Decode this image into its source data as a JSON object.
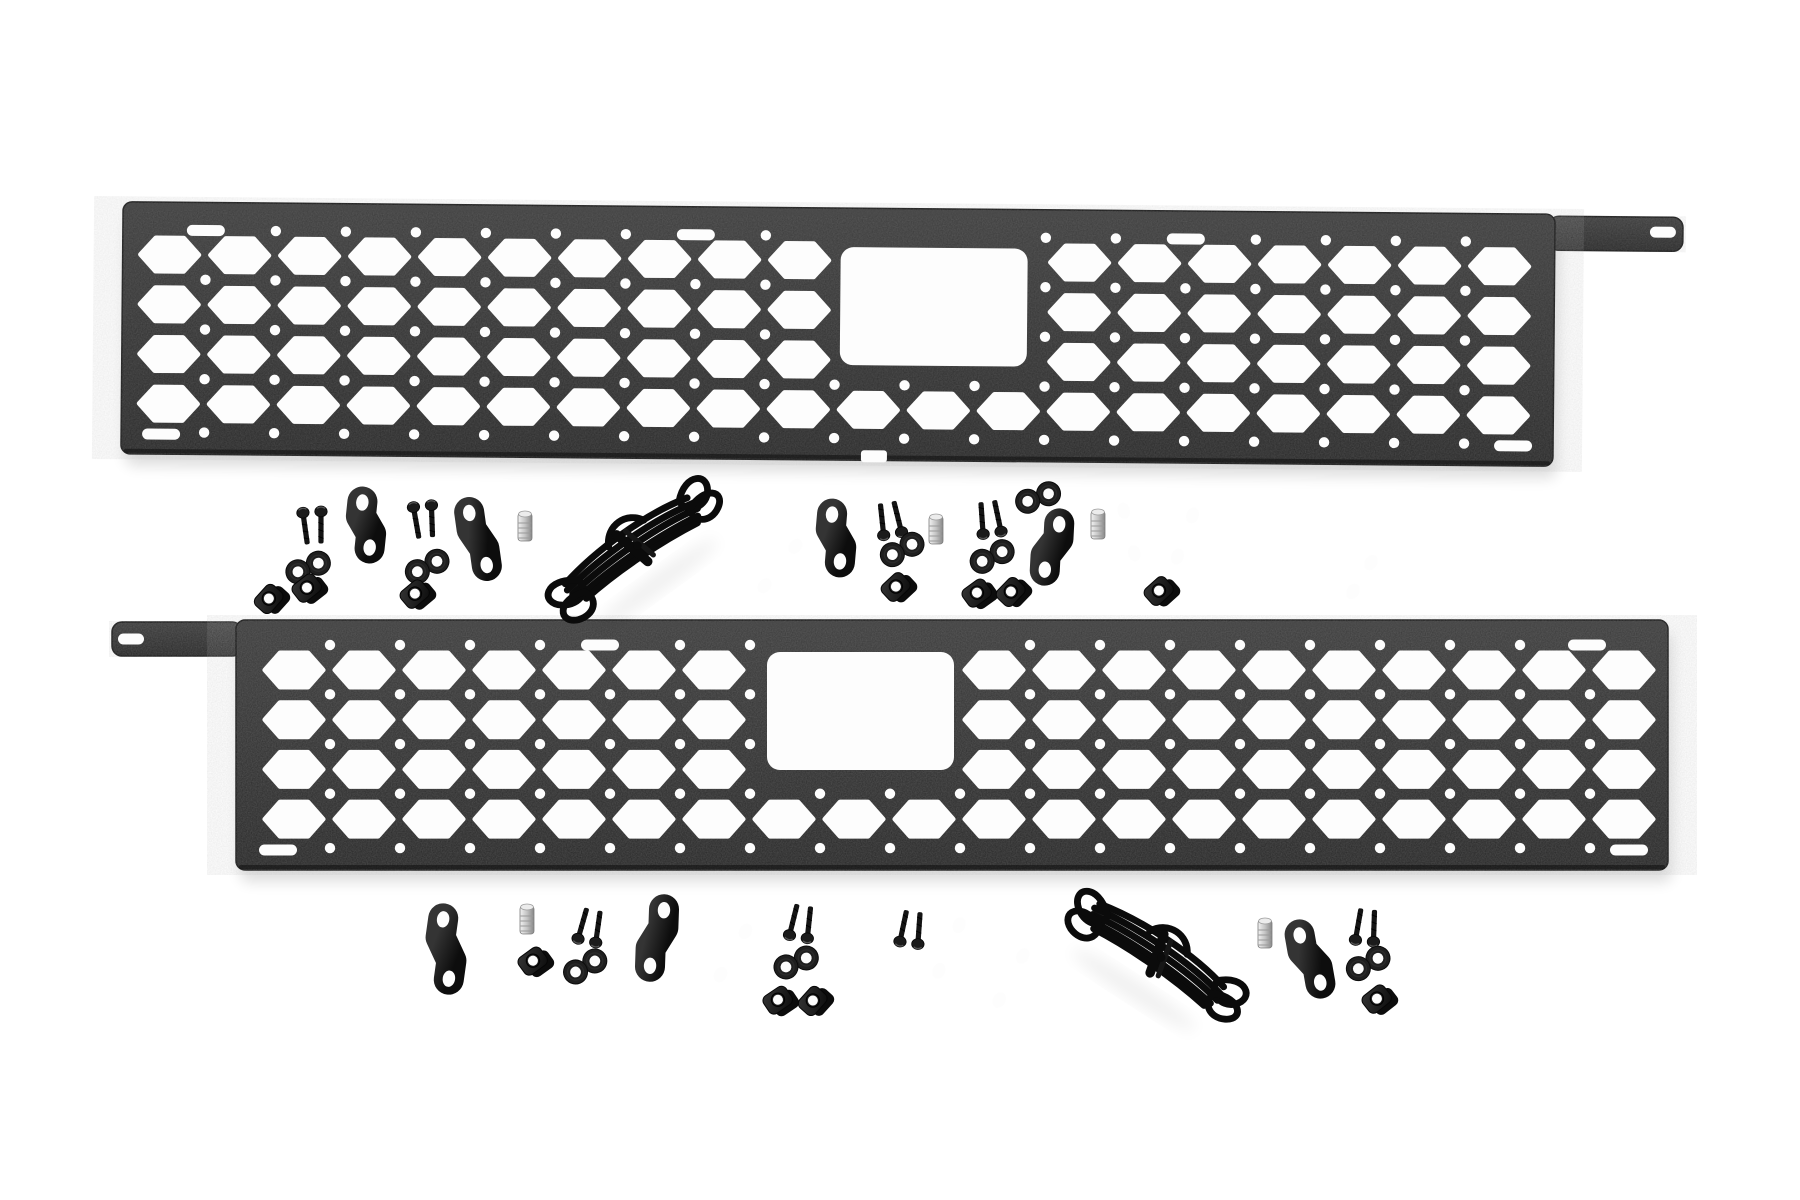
{
  "scene": {
    "width": 1800,
    "height": 1200,
    "background": "#ffffff",
    "subject": "molle-panel-kit-product-photo"
  },
  "colors": {
    "panelTop": "#3a3a3a",
    "panelBottom": "#252525",
    "panelEdge": "#161616",
    "panelHighlight": "#4a4a4a",
    "hole": "#fdfdfd",
    "strapLight": "#343434",
    "strapDark": "#0d0d0d",
    "hardware": "#141414",
    "washer": "#1f1f1f",
    "cord": "#0b0b0b",
    "studLight": "#f2f2f2",
    "studMid": "#c4c4c4",
    "studDark": "#878787",
    "shadow": "#000000"
  },
  "panels": [
    {
      "name": "molle-panel-top",
      "x": 122,
      "y": 208,
      "width": 1432,
      "height": 252,
      "rotation": 0.5,
      "tab": {
        "side": "right",
        "width": 134,
        "height": 34,
        "slot": {
          "x": 1662,
          "y": 225,
          "w": 26,
          "h": 11
        }
      },
      "window": {
        "x": 840,
        "y": 247,
        "w": 187,
        "h": 118,
        "r": 13
      },
      "grid": {
        "cols": 20,
        "colPitch": 70,
        "startX": 18,
        "hexW": 58,
        "hexH": 33,
        "rows": 4,
        "rowPitch": 49.7,
        "startY": 36
      },
      "slots": [
        {
          "x": 205,
          "y": 236
        },
        {
          "x": 695,
          "y": 236
        },
        {
          "x": 1185,
          "y": 236
        },
        {
          "x": 162,
          "y": 440
        },
        {
          "x": 1514,
          "y": 440
        }
      ],
      "notches": [
        {
          "x": 875,
          "y": 456
        }
      ]
    },
    {
      "name": "molle-panel-bottom",
      "x": 236,
      "y": 620,
      "width": 1432,
      "height": 250,
      "rotation": 0,
      "tab": {
        "side": "left",
        "width": 130,
        "height": 34,
        "slot": {
          "x": 131,
          "y": 639,
          "w": 26,
          "h": 11
        }
      },
      "window": {
        "x": 767,
        "y": 652,
        "w": 187,
        "h": 118,
        "r": 13
      },
      "grid": {
        "cols": 20,
        "colPitch": 70,
        "startX": 29,
        "hexW": 58,
        "hexH": 34,
        "rows": 4,
        "rowPitch": 49.7,
        "startY": 33
      },
      "slots": [
        {
          "x": 600,
          "y": 645
        },
        {
          "x": 1587,
          "y": 645
        },
        {
          "x": 278,
          "y": 850
        },
        {
          "x": 1629,
          "y": 850
        }
      ],
      "notches": []
    }
  ],
  "hardware": [
    {
      "type": "screw-pair",
      "x": 313,
      "y": 527,
      "rot": -4,
      "flip": false
    },
    {
      "type": "washer-pair",
      "x": 308,
      "y": 567,
      "rot": 75
    },
    {
      "type": "clip-nut",
      "x": 268,
      "y": 599,
      "rot": -30
    },
    {
      "type": "clip-nut",
      "x": 306,
      "y": 588,
      "rot": -20
    },
    {
      "type": "z-bracket",
      "x": 366,
      "y": 525,
      "rot": 6,
      "len": 46,
      "dx": 12
    },
    {
      "type": "screw-pair",
      "x": 424,
      "y": 521,
      "rot": -6,
      "flip": false
    },
    {
      "type": "washer-pair",
      "x": 427,
      "y": 566,
      "rot": 70
    },
    {
      "type": "clip-nut",
      "x": 414,
      "y": 594,
      "rot": -22
    },
    {
      "type": "z-bracket",
      "x": 478,
      "y": 539,
      "rot": -8,
      "len": 56,
      "dx": 10
    },
    {
      "type": "stud",
      "x": 525,
      "y": 527,
      "rot": 0
    },
    {
      "type": "bracket",
      "x": 780,
      "y": 566,
      "rot": 38,
      "len": 52
    },
    {
      "type": "z-bracket",
      "x": 836,
      "y": 538,
      "rot": 5,
      "len": 48,
      "dx": 12
    },
    {
      "type": "screw-pair",
      "x": 890,
      "y": 519,
      "rot": -10,
      "flip": true
    },
    {
      "type": "washer-pair",
      "x": 902,
      "y": 549,
      "rot": 70
    },
    {
      "type": "clip-nut",
      "x": 895,
      "y": 587,
      "rot": -25
    },
    {
      "type": "stud",
      "x": 936,
      "y": 530,
      "rot": 0
    },
    {
      "type": "screw-pair",
      "x": 990,
      "y": 518,
      "rot": -8,
      "flip": true
    },
    {
      "type": "washer-pair",
      "x": 992,
      "y": 556,
      "rot": 72
    },
    {
      "type": "clip-nut",
      "x": 976,
      "y": 593,
      "rot": -18
    },
    {
      "type": "clip-nut",
      "x": 1010,
      "y": 592,
      "rot": -28
    },
    {
      "type": "washer-pair",
      "x": 1038,
      "y": 497,
      "rot": 78
    },
    {
      "type": "z-bracket",
      "x": 1052,
      "y": 547,
      "rot": 3,
      "len": 48,
      "dx": -12
    },
    {
      "type": "stud",
      "x": 1098,
      "y": 525,
      "rot": 0
    },
    {
      "type": "bracket",
      "x": 1129,
      "y": 532,
      "rot": -14,
      "len": 46
    },
    {
      "type": "bracket",
      "x": 1185,
      "y": 536,
      "rot": 20,
      "len": 46
    },
    {
      "type": "clip-nut",
      "x": 1158,
      "y": 591,
      "rot": -24
    },
    {
      "type": "bracket",
      "x": 1362,
      "y": 577,
      "rot": 32,
      "len": 36
    },
    {
      "type": "z-bracket",
      "x": 446,
      "y": 949,
      "rot": 8,
      "len": 60,
      "dx": 14
    },
    {
      "type": "stud",
      "x": 527,
      "y": 920,
      "rot": 0
    },
    {
      "type": "clip-nut",
      "x": 532,
      "y": 961,
      "rot": -18
    },
    {
      "type": "screw-pair",
      "x": 590,
      "y": 926,
      "rot": 12,
      "flip": true
    },
    {
      "type": "washer-pair",
      "x": 585,
      "y": 966,
      "rot": 68
    },
    {
      "type": "z-bracket",
      "x": 657,
      "y": 938,
      "rot": 2,
      "len": 58,
      "dx": -12
    },
    {
      "type": "bracket",
      "x": 733,
      "y": 953,
      "rot": 30,
      "len": 52
    },
    {
      "type": "screw-pair",
      "x": 801,
      "y": 922,
      "rot": 10,
      "flip": true
    },
    {
      "type": "washer-pair",
      "x": 796,
      "y": 962,
      "rot": 74
    },
    {
      "type": "clip-nut",
      "x": 777,
      "y": 1000,
      "rot": -16
    },
    {
      "type": "clip-nut",
      "x": 812,
      "y": 1001,
      "rot": -30
    },
    {
      "type": "screw-pair",
      "x": 911,
      "y": 928,
      "rot": 8,
      "flip": true
    },
    {
      "type": "bracket",
      "x": 949,
      "y": 948,
      "rot": 24,
      "len": 52
    },
    {
      "type": "bracket",
      "x": 1011,
      "y": 978,
      "rot": 28,
      "len": 52
    },
    {
      "type": "stud",
      "x": 1265,
      "y": 934,
      "rot": 0
    },
    {
      "type": "z-bracket",
      "x": 1310,
      "y": 959,
      "rot": -10,
      "len": 52,
      "dx": 12
    },
    {
      "type": "screw-pair",
      "x": 1366,
      "y": 926,
      "rot": 6,
      "flip": true
    },
    {
      "type": "washer-pair",
      "x": 1368,
      "y": 963,
      "rot": 70
    },
    {
      "type": "clip-nut",
      "x": 1376,
      "y": 999,
      "rot": -20
    }
  ],
  "cords": [
    {
      "x": 632,
      "y": 547,
      "rot": -36
    },
    {
      "x": 1158,
      "y": 953,
      "rot": 33
    }
  ]
}
